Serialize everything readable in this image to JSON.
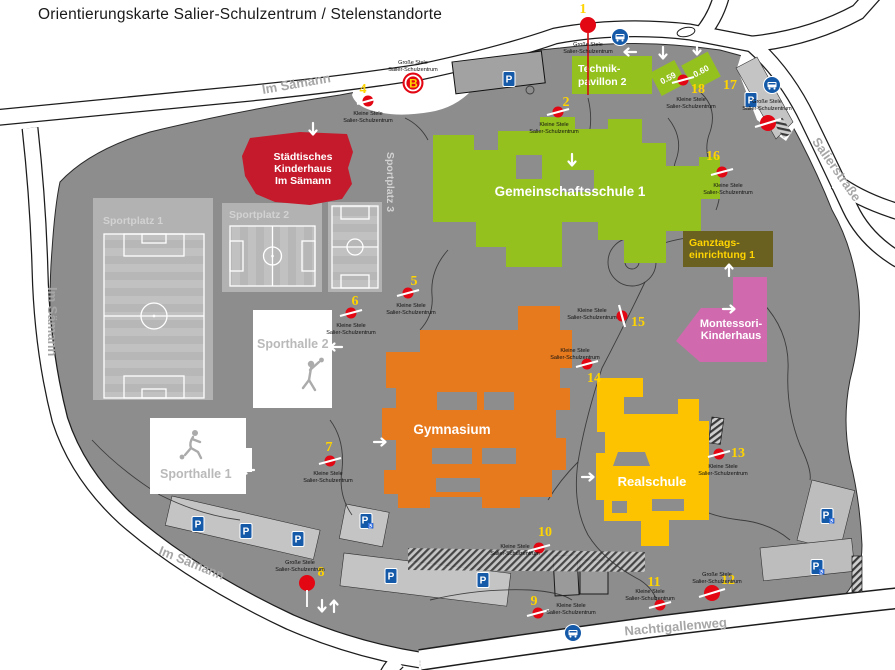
{
  "title": "Orientierungskarte Salier-Schulzentrum / Stelenstandorte",
  "streets": {
    "im_saemann": "Im Sämann",
    "salierstrasse": "Salierstraße",
    "nachtigallenweg": "Nachtigallenweg"
  },
  "buildings": {
    "kinderhaus": {
      "lines": [
        "Städtisches",
        "Kinderhaus",
        "Im Sämann"
      ]
    },
    "technikpavillon": {
      "lines": [
        "Technik-",
        "pavillon 2"
      ]
    },
    "pavillon_059": "0.59",
    "pavillon_060": "0.60",
    "gemeinschaftsschule": "Gemeinschaftsschule 1",
    "ganztagseinrichtung": {
      "lines": [
        "Ganztags-",
        "einrichtung 1"
      ]
    },
    "montessori": {
      "lines": [
        "Montessori-",
        "Kinderhaus"
      ]
    },
    "gymnasium": "Gymnasium",
    "realschule": "Realschule",
    "sporthalle1": "Sporthalle 1",
    "sporthalle2": "Sporthalle 2",
    "sportplatz1": "Sportplatz 1",
    "sportplatz2": "Sportplatz 2",
    "sportplatz3": "Sportplatz 3"
  },
  "stele": {
    "grosse": [
      "Große Stele",
      "Salier-Schulzentrum"
    ],
    "kleine": [
      "Kleine Stele",
      "Salier-Schulzentrum"
    ],
    "b_symbol": "B"
  },
  "markers": [
    {
      "n": "1",
      "size": "grosse"
    },
    {
      "n": "2",
      "size": "kleine"
    },
    {
      "n": "4",
      "size": "kleine"
    },
    {
      "n": "5",
      "size": "kleine"
    },
    {
      "n": "6",
      "size": "kleine"
    },
    {
      "n": "7",
      "size": "kleine"
    },
    {
      "n": "8",
      "size": "grosse"
    },
    {
      "n": "9",
      "size": "kleine"
    },
    {
      "n": "10",
      "size": "kleine"
    },
    {
      "n": "11",
      "size": "kleine"
    },
    {
      "n": "12",
      "size": "grosse"
    },
    {
      "n": "13",
      "size": "kleine"
    },
    {
      "n": "14",
      "size": "kleine"
    },
    {
      "n": "15",
      "size": "kleine"
    },
    {
      "n": "16",
      "size": "kleine"
    },
    {
      "n": "17",
      "size": "grosse"
    },
    {
      "n": "18",
      "size": "kleine"
    }
  ],
  "icons": {
    "parking_letter": "P",
    "wheelchair": "♿"
  },
  "colors": {
    "campus": "#8d8d8d",
    "school_green": "#95c11f",
    "gym_orange": "#e87a1e",
    "real_yellow": "#fdc300",
    "montessori_pink": "#d169ae",
    "kinderhaus_red": "#c51a2b",
    "ganztags_olive": "#6a6121",
    "stele_red": "#e30613",
    "number_yellow": "#ffd400",
    "icon_blue": "#155aa8"
  }
}
